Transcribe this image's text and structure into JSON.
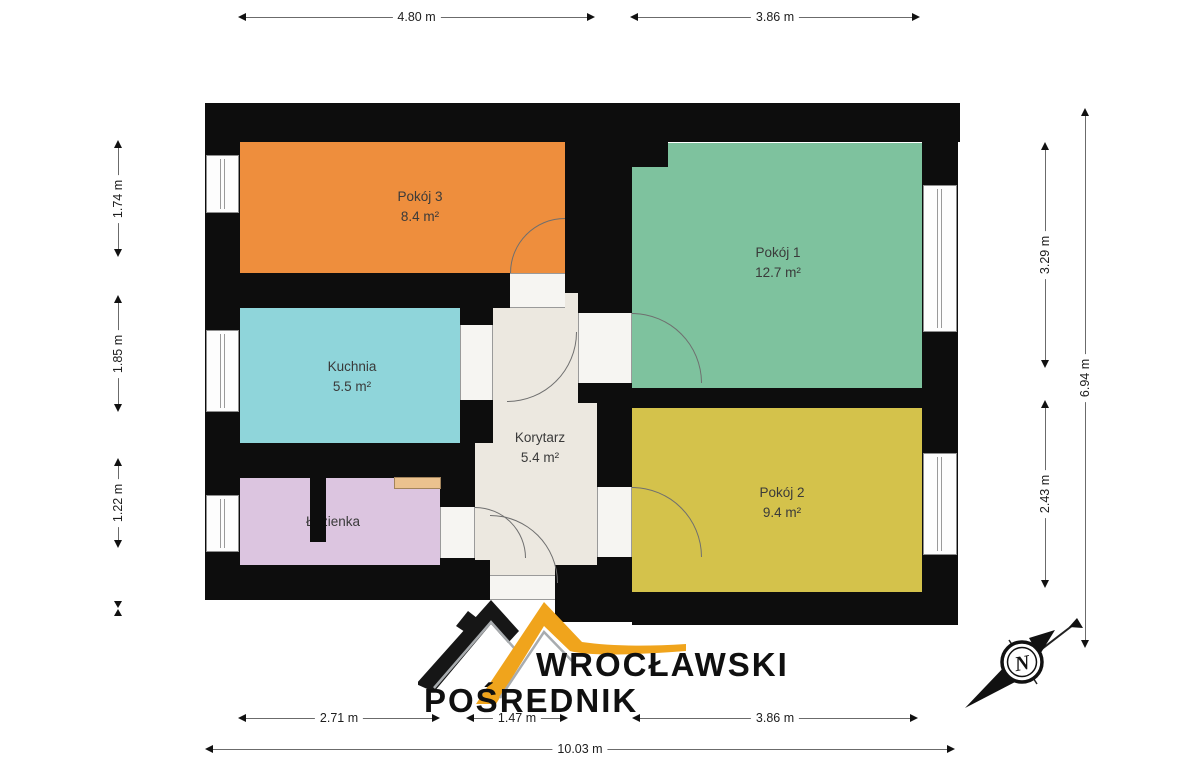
{
  "rooms": [
    {
      "name": "Pokój 3",
      "area": "8.4 m²",
      "color": "#EE8E3D"
    },
    {
      "name": "Pokój 1",
      "area": "12.7 m²",
      "color": "#7EC29E"
    },
    {
      "name": "Kuchnia",
      "area": "5.5 m²",
      "color": "#8FD5DA"
    },
    {
      "name": "Korytarz",
      "area": "5.4 m²",
      "color": "#ECE8E0"
    },
    {
      "name": "Łazienka",
      "area": "",
      "color": "#DCC5E0"
    },
    {
      "name": "Pokój 2",
      "area": "9.4 m²",
      "color": "#D4C24B"
    }
  ],
  "fixtures": {
    "shelf_color": "#EBC28F"
  },
  "dimensions": {
    "top": [
      {
        "label": "4.80 m"
      },
      {
        "label": "3.86 m"
      }
    ],
    "left": [
      {
        "label": "1.74 m"
      },
      {
        "label": "1.85 m"
      },
      {
        "label": "1.22 m"
      }
    ],
    "right_inner": [
      {
        "label": "3.29 m"
      },
      {
        "label": "2.43 m"
      }
    ],
    "right_outer": {
      "label": "6.94 m"
    },
    "bottom_inner": [
      {
        "label": "2.71 m"
      },
      {
        "label": "1.47 m"
      },
      {
        "label": "3.86 m"
      }
    ],
    "bottom_outer": {
      "label": "10.03 m"
    }
  },
  "logo": {
    "line1": "WROCŁAWSKI",
    "line2": "POŚREDNIK",
    "gold": "#F0A41C",
    "black": "#161616",
    "gray": "#A8ACAF"
  },
  "compass": {
    "north_label": "N"
  }
}
